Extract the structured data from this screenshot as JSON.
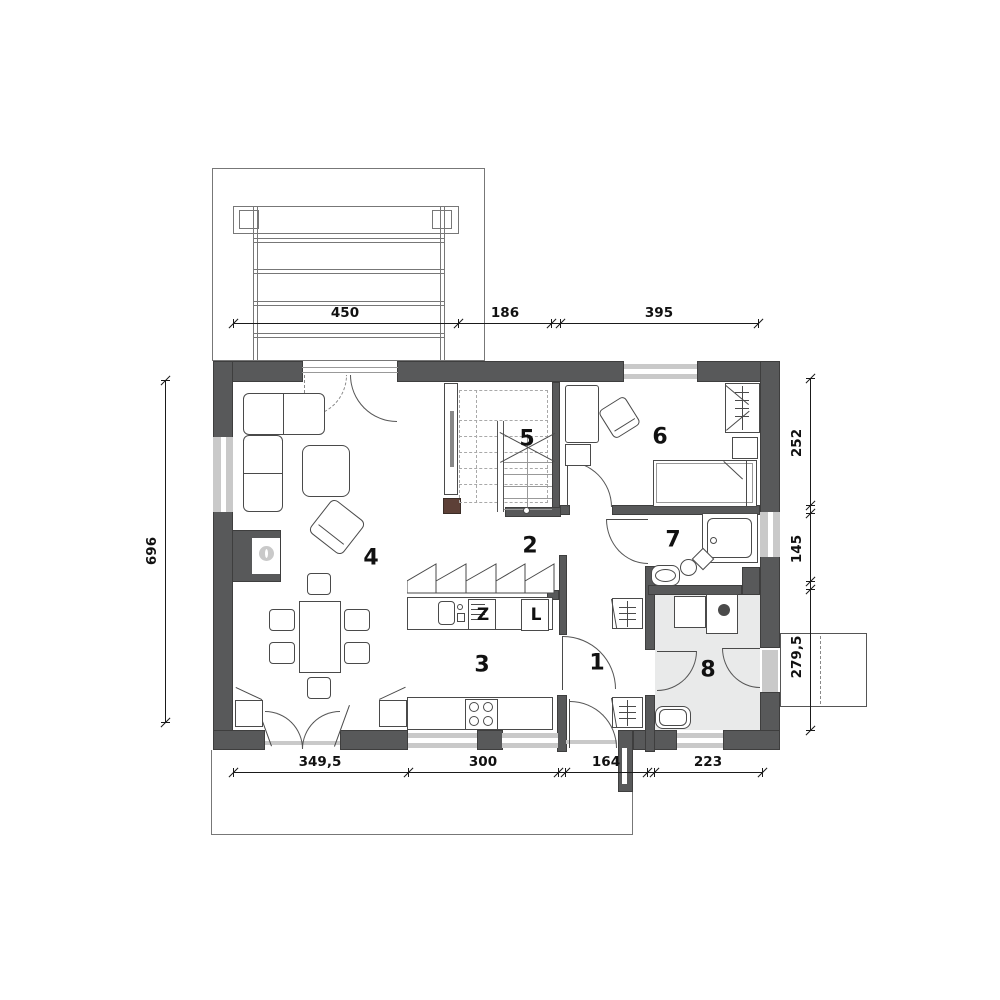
{
  "plan_title": "Single-family house ground floor plan",
  "rooms": [
    "1",
    "2",
    "3",
    "4",
    "5",
    "6",
    "7",
    "8"
  ],
  "dimensions": {
    "top": [
      "450",
      "186",
      "395"
    ],
    "bottom": [
      "349,5",
      "300",
      "164",
      "223"
    ],
    "left": [
      "696"
    ],
    "right": [
      "252",
      "145",
      "279,5"
    ]
  },
  "kitchen": {
    "dishwasher_label": "Z",
    "fridge_label": "L"
  },
  "colors": {
    "wall": "#58595a",
    "window": "#c9c9c9",
    "utility_floor": "#e9eaea",
    "fireplace_brown": "#5d4037"
  }
}
